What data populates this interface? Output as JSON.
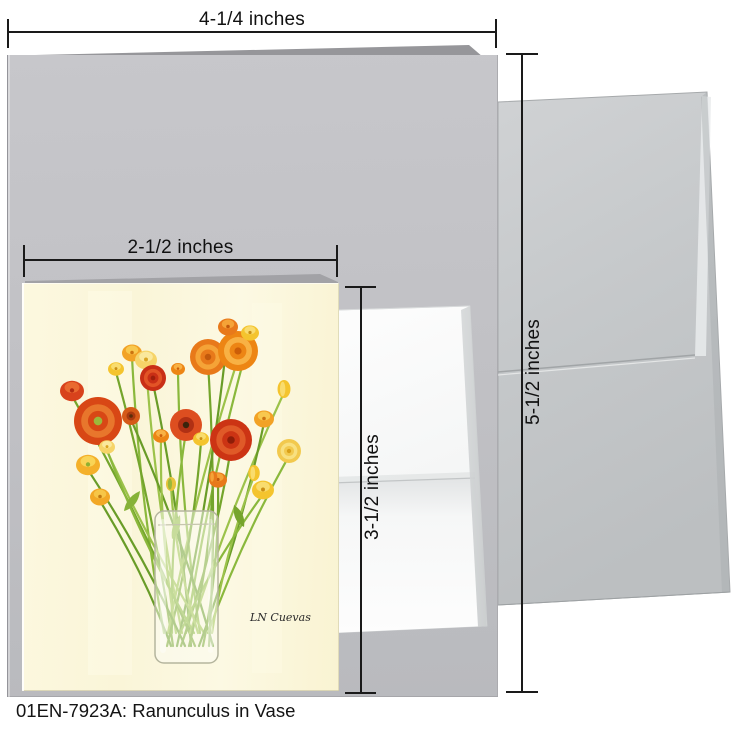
{
  "caption": {
    "text": "01EN-7923A: Ranunculus in Vase"
  },
  "dimensions": {
    "card_width": "4-1/4 inches",
    "card_height": "5-1/2 inches",
    "artwork_width": "2-1/2 inches",
    "artwork_height": "3-1/2 inches"
  },
  "colors": {
    "card_gray": "#c0c0c4",
    "envelope_gray": "#c5c8ca",
    "insert_white": "#f7f8f9",
    "art_background": "#fbf7da",
    "dimension_line": "#1a1a1a",
    "vase_outline": "#b5b59e",
    "stem_greens": [
      "#8ab83c",
      "#74a52c",
      "#9cc24a",
      "#699c28"
    ]
  },
  "artwork": {
    "title": "Ranunculus in Vase",
    "signature": "LN Cuevas",
    "flowers": [
      {
        "x": 110,
        "y": 70,
        "r": 10,
        "t": "cup",
        "c": [
          "#F2A226",
          "#F8C84E",
          "#CC7410"
        ]
      },
      {
        "x": 94,
        "y": 86,
        "r": 8,
        "t": "cup",
        "c": [
          "#F4C42E",
          "#F9DC6E",
          "#C98E14"
        ]
      },
      {
        "x": 124,
        "y": 77,
        "r": 11,
        "t": "cup",
        "c": [
          "#F6D468",
          "#FAE89C",
          "#D9A422"
        ]
      },
      {
        "x": 131,
        "y": 95,
        "r": 13,
        "t": "rose",
        "c": [
          "#C92F16",
          "#E25426",
          "#9E1F0C"
        ]
      },
      {
        "x": 156,
        "y": 86,
        "r": 7,
        "t": "cup",
        "c": [
          "#ED8514",
          "#F8B144",
          "#CC5E08"
        ]
      },
      {
        "x": 186,
        "y": 74,
        "r": 18,
        "t": "rose",
        "c": [
          "#E8791A",
          "#F5A337",
          "#C2590C"
        ]
      },
      {
        "x": 216,
        "y": 68,
        "r": 20,
        "t": "rose",
        "c": [
          "#ED8514",
          "#F8B144",
          "#CC5E08"
        ]
      },
      {
        "x": 206,
        "y": 44,
        "r": 10,
        "t": "cup",
        "c": [
          "#E8791A",
          "#F5A337",
          "#C2590C"
        ]
      },
      {
        "x": 228,
        "y": 50,
        "r": 9,
        "t": "cup",
        "c": [
          "#F4C42E",
          "#F9DC6E",
          "#C98E14"
        ]
      },
      {
        "x": 50,
        "y": 108,
        "r": 12,
        "t": "cup",
        "c": [
          "#D8421C",
          "#E96A30",
          "#B22A10"
        ]
      },
      {
        "x": 76,
        "y": 138,
        "r": 24,
        "t": "rose",
        "c": [
          "#D84715",
          "#E8762C",
          "#9CB83A"
        ]
      },
      {
        "x": 109,
        "y": 133,
        "r": 9,
        "t": "poppy",
        "c": [
          "#D55A18",
          "#A83A10",
          "#5A2E0A"
        ]
      },
      {
        "x": 164,
        "y": 142,
        "r": 16,
        "t": "poppy",
        "c": [
          "#DD4E20",
          "#B03014",
          "#3A240C"
        ]
      },
      {
        "x": 209,
        "y": 157,
        "r": 21,
        "t": "rose",
        "c": [
          "#CC3414",
          "#E05A28",
          "#8E1E08"
        ]
      },
      {
        "x": 262,
        "y": 106,
        "r": 9,
        "t": "bud",
        "c": [
          "#F4C42E",
          "#F9DC6E",
          "#C98E14"
        ]
      },
      {
        "x": 242,
        "y": 136,
        "r": 10,
        "t": "cup",
        "c": [
          "#F2A226",
          "#F8C84E",
          "#CC7410"
        ]
      },
      {
        "x": 267,
        "y": 168,
        "r": 12,
        "t": "rose",
        "c": [
          "#F2C94E",
          "#F8E080",
          "#D9A018"
        ]
      },
      {
        "x": 179,
        "y": 156,
        "r": 8,
        "t": "cup",
        "c": [
          "#F4C42E",
          "#F9DC6E",
          "#C98E14"
        ]
      },
      {
        "x": 139,
        "y": 153,
        "r": 8,
        "t": "cup",
        "c": [
          "#ED8514",
          "#F8B144",
          "#CC5E08"
        ]
      },
      {
        "x": 66,
        "y": 182,
        "r": 12,
        "t": "cup",
        "c": [
          "#F4B02A",
          "#F9D456",
          "#8FB032"
        ]
      },
      {
        "x": 85,
        "y": 164,
        "r": 8,
        "t": "cup",
        "c": [
          "#F6D468",
          "#FAE89C",
          "#D9A422"
        ]
      },
      {
        "x": 196,
        "y": 197,
        "r": 9,
        "t": "cup",
        "c": [
          "#E8791A",
          "#F5A337",
          "#C2590C"
        ]
      },
      {
        "x": 232,
        "y": 190,
        "r": 8,
        "t": "bud",
        "c": [
          "#F4C42E",
          "#F9DC6E",
          "#C98E14"
        ]
      },
      {
        "x": 78,
        "y": 214,
        "r": 10,
        "t": "cup",
        "c": [
          "#F2A826",
          "#F6C648",
          "#C07810"
        ]
      },
      {
        "x": 241,
        "y": 207,
        "r": 11,
        "t": "cup",
        "c": [
          "#F4C42E",
          "#F9DC6E",
          "#C98E14"
        ]
      },
      {
        "x": 191,
        "y": 194,
        "r": 6,
        "t": "bud",
        "c": [
          "#E8791A",
          "#F5A337",
          "#C2590C"
        ]
      },
      {
        "x": 149,
        "y": 201,
        "r": 7,
        "t": "bud",
        "c": [
          "#E8C43C",
          "#9CB83A",
          "#C89614"
        ]
      }
    ]
  }
}
